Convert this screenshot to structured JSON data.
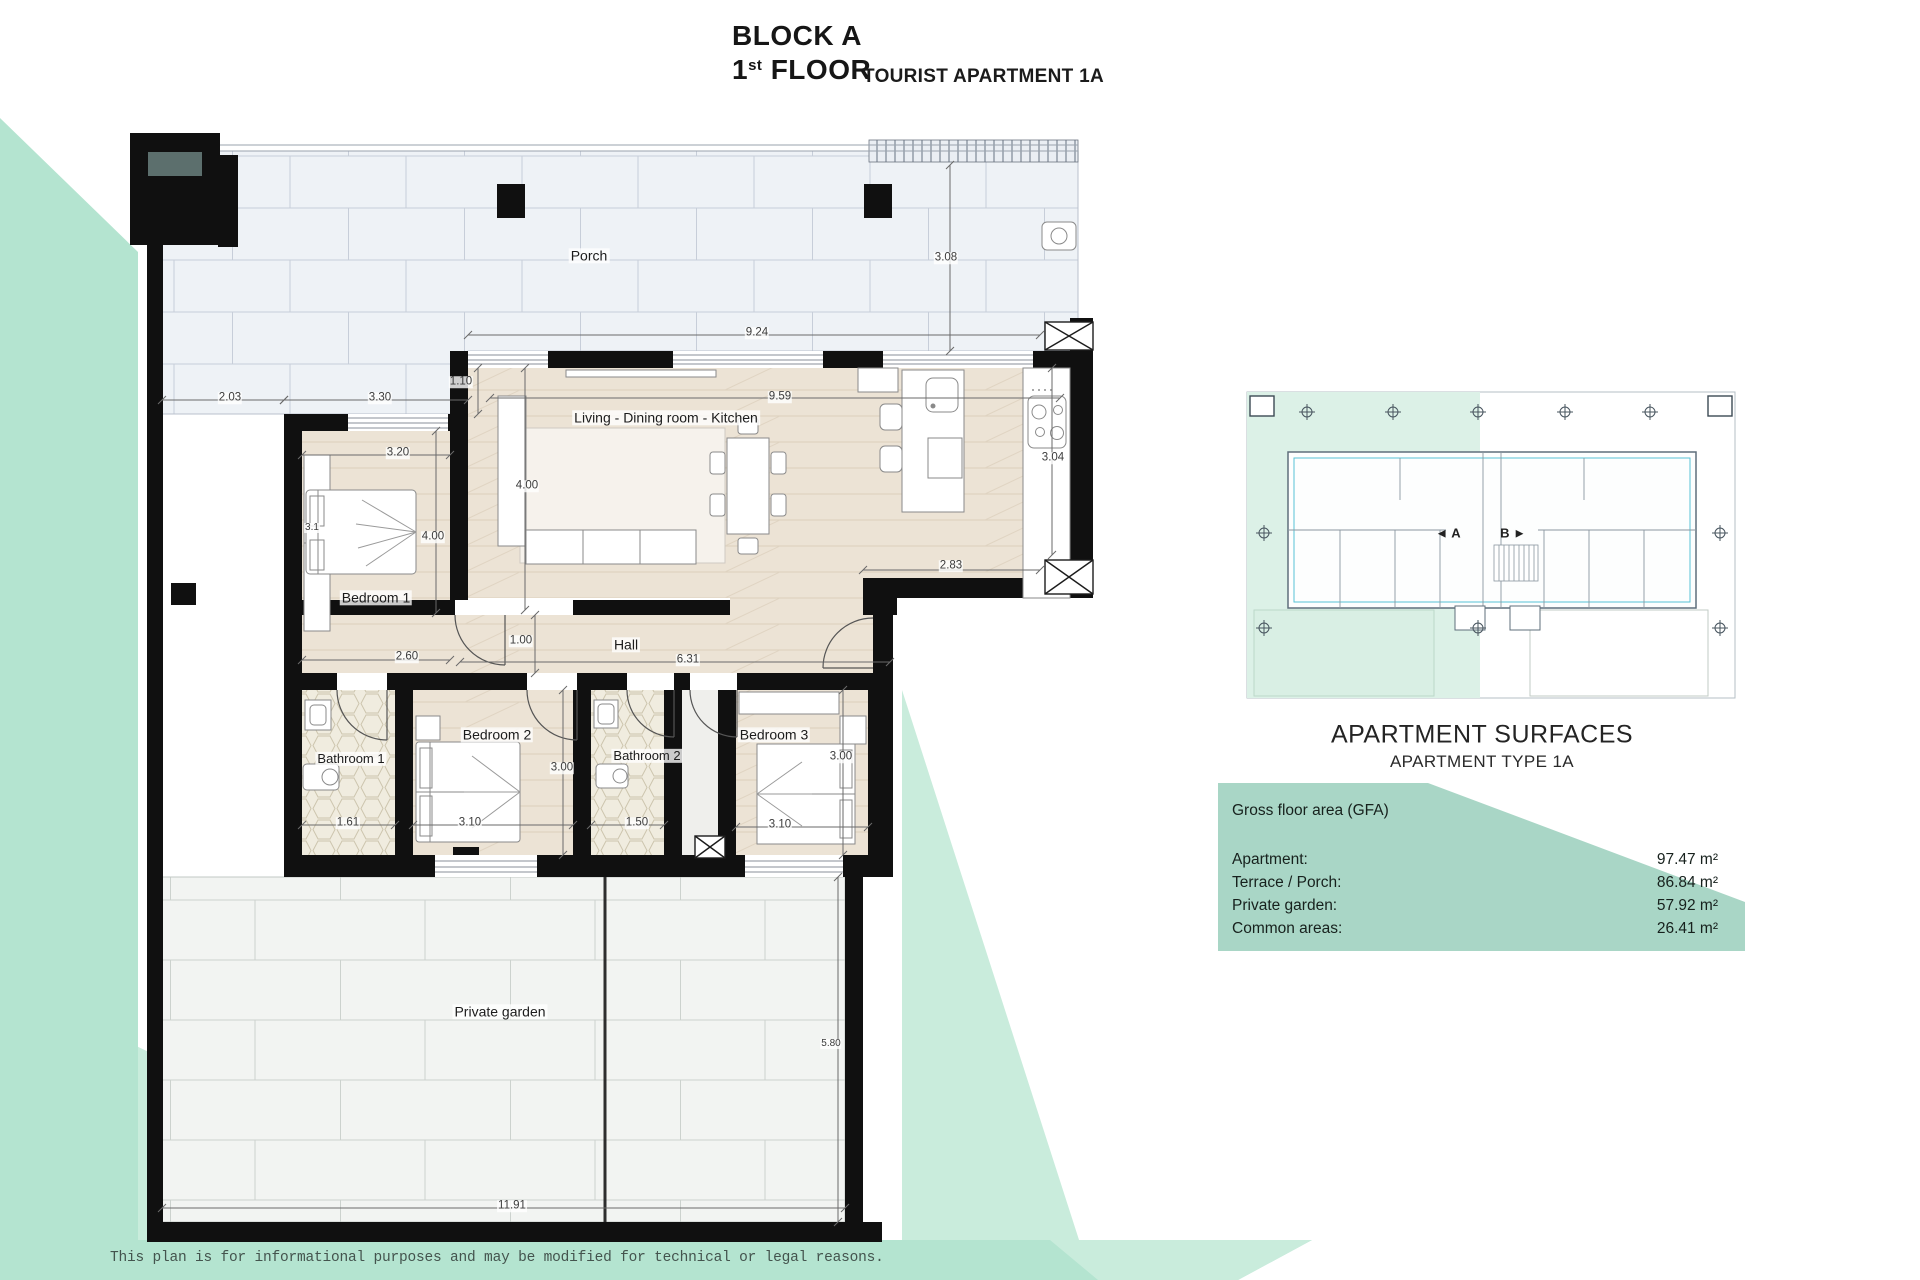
{
  "title": {
    "block": "BLOCK A",
    "floor_number": "1",
    "floor_ordinal": "st",
    "floor_word": " FLOOR",
    "apartment": "TOURIST APARTMENT 1A"
  },
  "plan": {
    "rooms": {
      "porch": "Porch",
      "living": "Living - Dining room - Kitchen",
      "bedroom1": "Bedroom 1",
      "hall": "Hall",
      "bathroom1": "Bathroom 1",
      "bedroom2": "Bedroom 2",
      "bathroom2": "Bathroom 2",
      "bedroom3": "Bedroom 3",
      "garden": "Private garden"
    },
    "dims": {
      "left_offset": "2.03",
      "bed1_top": "3.30",
      "porch_step": "1.10",
      "porch_width": "9.24",
      "porch_depth": "3.08",
      "living_width": "9.59",
      "living_height": "4.00",
      "bed1_width": "3.20",
      "bed1_bed": "3.1",
      "bed1_height": "4.00",
      "kitchen_height": "3.04",
      "living_right_width": "2.83",
      "bed1_bottom": "2.60",
      "hall_width": "1.00",
      "hall_length": "6.31",
      "bath1_width": "1.61",
      "bed2_width": "3.10",
      "bed2_height": "3.00",
      "bath2_width": "1.50",
      "bed3_width": "3.10",
      "bed3_height": "3.00",
      "garden_height": "5.80",
      "garden_width": "11.91"
    }
  },
  "key_plan": {
    "unit_a": "◄ A",
    "unit_b": "B ►"
  },
  "surfaces": {
    "heading": "APARTMENT SURFACES",
    "subheading": "APARTMENT TYPE 1A",
    "gfa_label": "Gross floor area (GFA)",
    "rows": [
      {
        "label": "Apartment:",
        "value": "97.47 m²"
      },
      {
        "label": "Terrace / Porch:",
        "value": "86.84 m²"
      },
      {
        "label": "Private garden:",
        "value": "57.92 m²"
      },
      {
        "label": "Common areas:",
        "value": "26.41 m²"
      }
    ]
  },
  "disclaimer": "This plan is for informational purposes and may be modified for technical or legal reasons.",
  "colors": {
    "mint": "#b4e4d0",
    "mint_light": "#c9ecdc",
    "panel_teal": "#a9d6c6",
    "wall": "#101010",
    "wood": "#ece3d5",
    "porch_tile": "#eef2f6",
    "garden_tile": "#f2f4f2",
    "key_plan_cyan": "#57c3d5"
  }
}
